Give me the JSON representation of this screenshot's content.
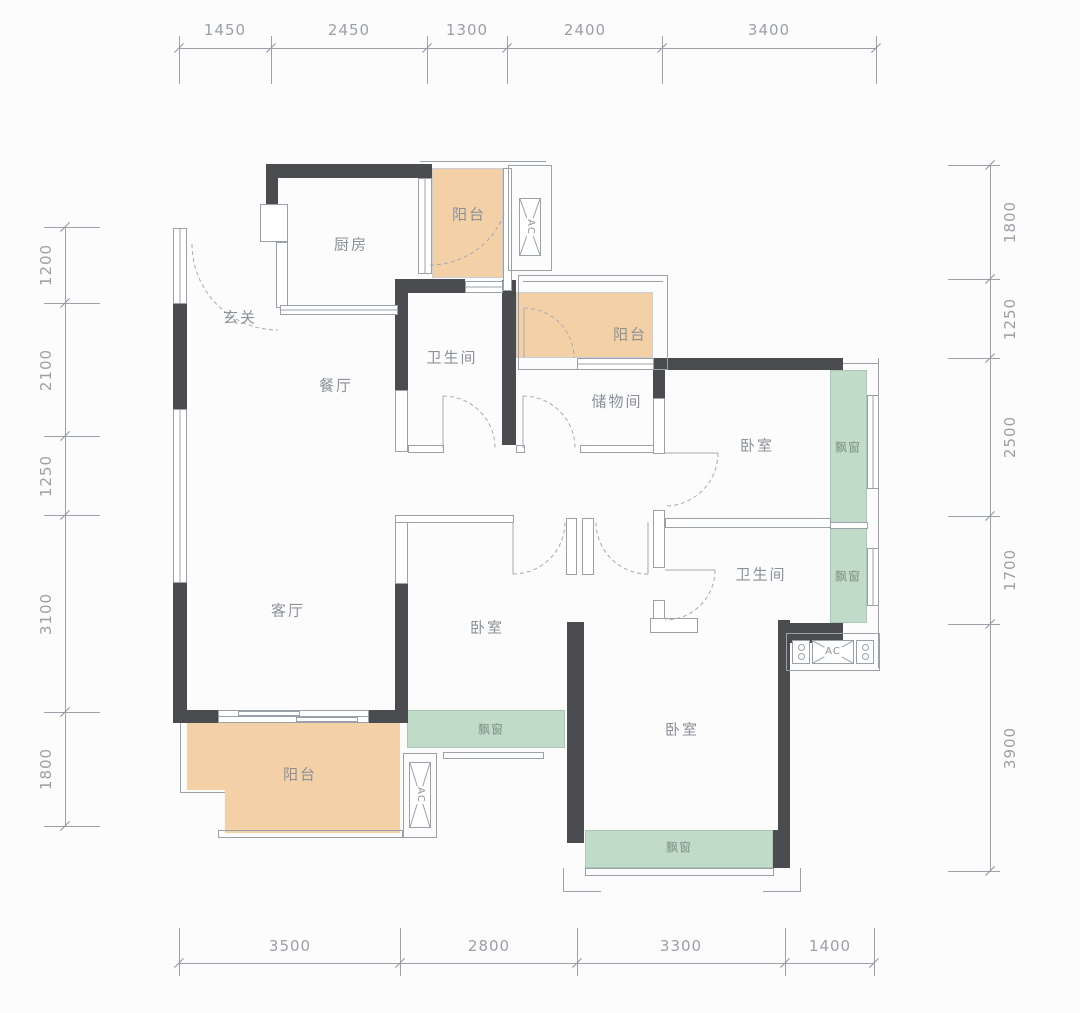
{
  "plan_title": "residential floor plan",
  "colors": {
    "wall": "#4b4c4f",
    "thin_line": "#9ba1a9",
    "balcony_fill": "#f4d0a7",
    "bay_window_fill": "#c0dcc8",
    "label_text": "#8b9199",
    "dimension_text": "#9b9fa6"
  },
  "rooms": {
    "kitchen": "厨房",
    "balcony_top": "阳台",
    "entry": "玄关",
    "bath1": "卫生间",
    "balcony_mid": "阳台",
    "storage": "储物间",
    "bedroom1": "卧室",
    "dining": "餐厅",
    "living": "客厅",
    "bedroom2": "卧室",
    "bath2": "卫生间",
    "bedroom3": "卧室",
    "balcony_bottom": "阳台",
    "ac": "AC"
  },
  "bays": {
    "bed1": "飘窗",
    "bath2": "飘窗",
    "bed2": "飘窗",
    "bed3": "飘窗"
  },
  "dimensions": {
    "top": [
      "1450",
      "2450",
      "1300",
      "2400",
      "3400"
    ],
    "bottom": [
      "3500",
      "2800",
      "3300",
      "1400"
    ],
    "left": [
      "1200",
      "2100",
      "1250",
      "3100",
      "1800"
    ],
    "right": [
      "1800",
      "1250",
      "2500",
      "1700",
      "3900"
    ]
  }
}
